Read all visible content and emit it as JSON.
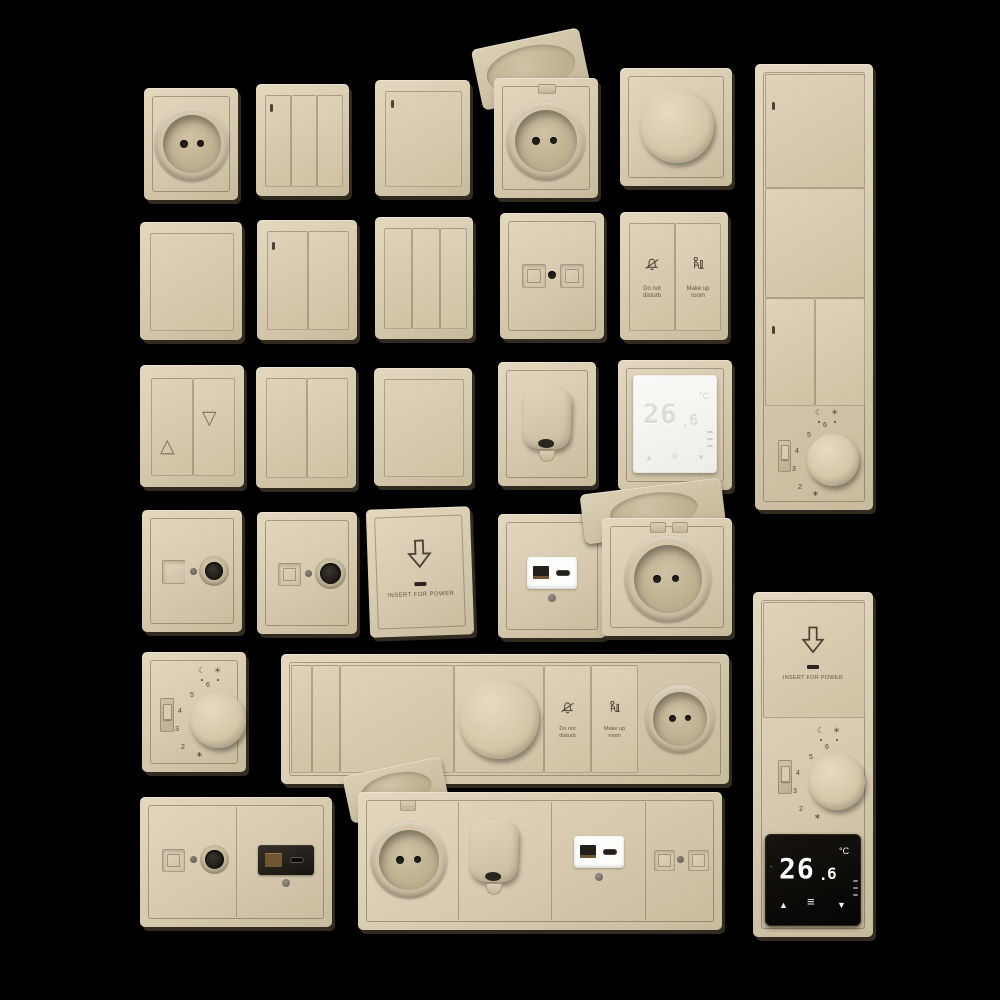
{
  "colors": {
    "background": "#000000",
    "plate_beige": "#d6c9ae",
    "plate_shadow": "#3a3226",
    "engraving": "#4a4337",
    "display_white": "#f6f5f2",
    "display_black": "#0b0a08",
    "digit_white": "#ffffff",
    "usb_gold": "#8a6b35"
  },
  "icons": {
    "moon": "☾",
    "sun": "☀",
    "star": "∗",
    "triangle_up_outline": "△",
    "triangle_down_outline": "▽",
    "triangle_up": "▲",
    "triangle_down": "▼",
    "menu": "≡",
    "degree_dot": "."
  },
  "dial": {
    "numbers": [
      "2",
      "3",
      "4",
      "5",
      "6"
    ]
  },
  "buttons": {
    "dnd_line1": "Do not",
    "dnd_line2": "disturb",
    "mur_line1": "Make up",
    "mur_line2": "room"
  },
  "keycard": {
    "label": "INSERT FOR POWER"
  },
  "thermostat": {
    "temp_int": "26",
    "temp_dec": "6",
    "unit": "°C"
  }
}
